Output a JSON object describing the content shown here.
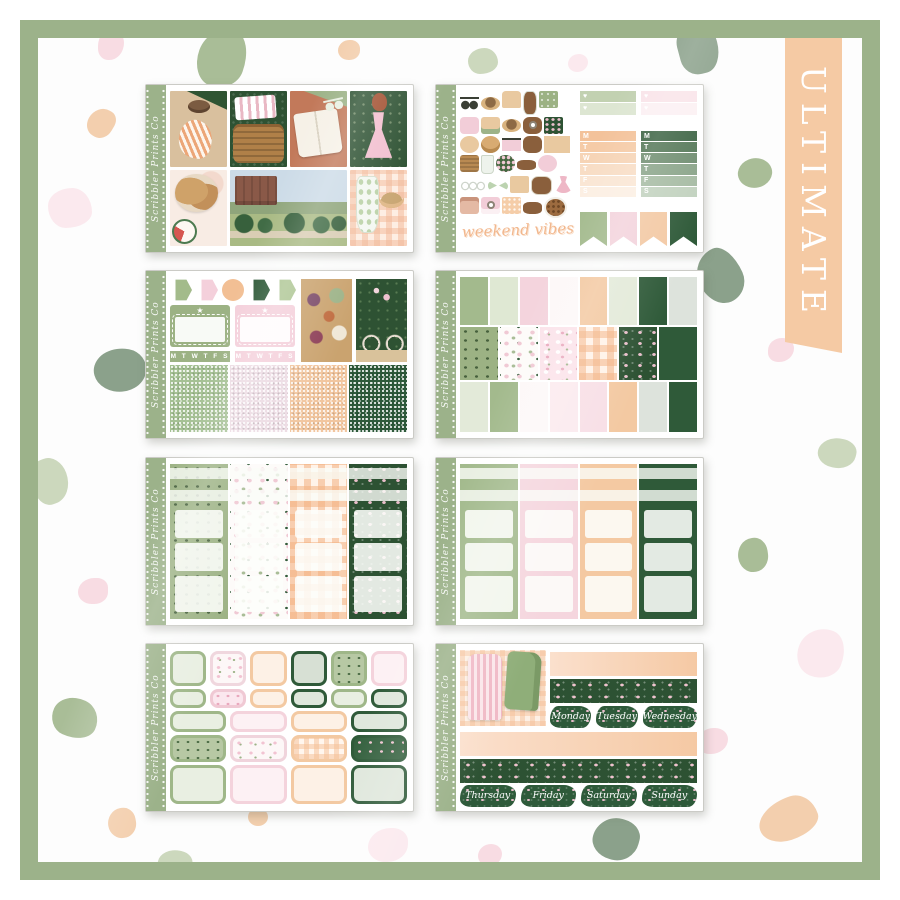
{
  "banner": {
    "label": "ULTIMATE",
    "color": "#f5caa4"
  },
  "watermark": "Scribbler Prints Co",
  "palette": {
    "frame_green": "#9cb28a",
    "sage": "#a3ba8d",
    "sage_light": "#dfe8d3",
    "pink": "#f4d4dd",
    "pink_light": "#fbeaee",
    "peach": "#f3c9a2",
    "peach_light": "#fdeede",
    "dark_green": "#2f5a39",
    "hedge_green": "#2d5233",
    "terracotta": "#c2795a",
    "terrazzo_sage": "#a9bd97",
    "terrazzo_peach": "#f3cfae",
    "terrazzo_pink": "#f8dce3"
  },
  "sheets": {
    "collage": {
      "tiles": [
        "lounging-woman",
        "picnic-basket-tile",
        "open-book-tile",
        "pink-dress-woman",
        "picnic-food",
        "manor-garden",
        "summer-drinks"
      ]
    },
    "deco": {
      "icons": [
        "sunglasses",
        "straw-hat",
        "fountain",
        "milk-bottle",
        "green-notebook",
        "picnic-pouch",
        "sandwich",
        "sun-hat",
        "camera",
        "floral-tile",
        "cookie-stack",
        "bread-basket",
        "sunglasses-2",
        "macaron",
        "bicycle",
        "picnic-basket",
        "drink-glass",
        "posy-ball",
        "serving-board",
        "doily",
        "chain-garland",
        "bow",
        "chocolate-bar",
        "book",
        "dress",
        "satchel",
        "instax-camera",
        "pattern-tile",
        "wire-glasses",
        "cookie-plate"
      ],
      "script_banner": "weekend vibes",
      "checklist_rows": [
        "♥",
        "♥",
        "♥"
      ],
      "date_letters": [
        "M",
        "T",
        "W",
        "T",
        "F",
        "S",
        "S"
      ],
      "pennants": [
        "pennant-sage",
        "pennant-pink",
        "pennant-peach",
        "pennant-dark"
      ]
    },
    "sampler": {
      "shapes": [
        "hx hx-sage",
        "hx hx-pink",
        "circle-peach",
        "hx hx-dark",
        "hx hx-sage2"
      ],
      "week_strip": "M T W T F S S",
      "glitters": [
        "glitter-sage",
        "glitter-pink",
        "glitter-peach",
        "glitter-dark"
      ]
    },
    "full_boxes": {
      "row1": [
        "c-sage",
        "c-ltsage",
        "c-pink",
        "c-white",
        "c-peach",
        "c-ltgreen",
        "c-dark",
        "c-ltgray"
      ],
      "row2": [
        "pat-greenleaf",
        "pat-terrazzo",
        "pat-pinkfloral",
        "pat-gingham",
        "pat-darkfloral",
        "c-dark"
      ],
      "row3": [
        "c-ltgreen",
        "c-sage",
        "c-white",
        "c-ltpink",
        "c-pinkish",
        "c-peach",
        "c-ltgray",
        "c-dark"
      ]
    },
    "half_boxes_patterned": {
      "columns": [
        "pat-greenleaf",
        "pat-terrazzo",
        "pat-gingham",
        "pat-darkfloral"
      ]
    },
    "half_boxes_solid": {
      "columns": [
        "col-sage",
        "col-pink",
        "col-peach",
        "col-dark"
      ]
    },
    "rounded_boxes": {
      "row1": [
        "rb-sage",
        "rb-floralwhite",
        "rb-peach",
        "rb-darkfill",
        "rb-sagepat",
        "rb-pink"
      ],
      "row2": [
        "rb-sage",
        "rb-pinkfloral",
        "rb-peach",
        "rb-dark",
        "rb-sage",
        "rb-dark"
      ],
      "row3": [
        "rb-sage",
        "rb-pink",
        "rb-peach",
        "rb-dark"
      ],
      "row4": [
        "rbp-sageleaf",
        "rbp-floral",
        "rbp-gingham",
        "rbp-dark"
      ],
      "row5": [
        "rb-sage",
        "rb-pink",
        "rb-peach",
        "rb-dark"
      ]
    },
    "date_covers": {
      "row1": [
        "Monday",
        "Tuesday",
        "Wednesday"
      ],
      "row2": [
        "Thursday",
        "Friday",
        "Saturday",
        "Sunday"
      ]
    }
  }
}
